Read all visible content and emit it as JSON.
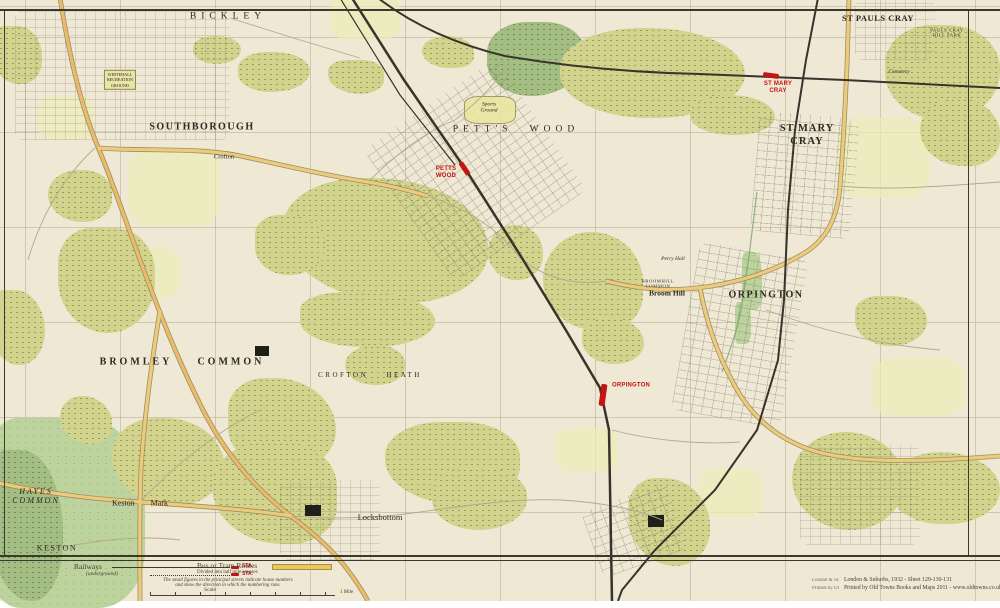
{
  "colors": {
    "paper": "#efe8d4",
    "woodland": "#d2d48e",
    "common_green": "#bdd39e",
    "road_main": "#eccb7d",
    "rail": "#36342c",
    "station_red": "#c41414",
    "grid": "#b9b096"
  },
  "places": [
    {
      "id": "bickley",
      "label": "BICKLEY",
      "x": 228,
      "y": 17,
      "cls": "town-wide"
    },
    {
      "id": "southborough",
      "label": "SOUTHBOROUGH",
      "x": 202,
      "y": 127,
      "cls": "town"
    },
    {
      "id": "petts-wood",
      "label": "PETT'S WOOD",
      "x": 516,
      "y": 130,
      "cls": "town-wide"
    },
    {
      "id": "st-pauls-cray",
      "label": "ST PAULS CRAY",
      "x": 878,
      "y": 19,
      "cls": "town-sm"
    },
    {
      "id": "pauls-cray-hill-park",
      "label": "PAULS CRAY\nHILL PARK",
      "x": 947,
      "y": 33,
      "cls": "tiny-caps"
    },
    {
      "id": "st-mary-cray",
      "label": "ST MARY\nCRAY",
      "x": 807,
      "y": 135,
      "cls": "town-2line"
    },
    {
      "id": "orpington",
      "label": "ORPINGTON",
      "x": 766,
      "y": 295,
      "cls": "town"
    },
    {
      "id": "bromley-common",
      "label": "BROMLEY COMMON",
      "x": 182,
      "y": 362,
      "cls": "town-gap"
    },
    {
      "id": "crofton-heath",
      "label": "CROFTON HEATH",
      "x": 370,
      "y": 375,
      "cls": "small-caps"
    },
    {
      "id": "hayes-common",
      "label": "HAYES\nCOMMON",
      "x": 36,
      "y": 496,
      "cls": "common-label"
    },
    {
      "id": "keston-mark",
      "label": "Keston Mark",
      "x": 140,
      "y": 503,
      "cls": "village-gap"
    },
    {
      "id": "keston",
      "label": "KESTON",
      "x": 57,
      "y": 548,
      "cls": "village-caps"
    },
    {
      "id": "locksbottom",
      "label": "Locksbottom",
      "x": 380,
      "y": 518,
      "cls": "village"
    },
    {
      "id": "broom-hill",
      "label": "Broom Hill",
      "x": 667,
      "y": 294,
      "cls": "hamlet"
    },
    {
      "id": "broomhill-common",
      "label": "BROOMHILL\nCOMMON",
      "x": 658,
      "y": 284,
      "cls": "tiny-caps"
    },
    {
      "id": "perry-hall",
      "label": "Perry Hall",
      "x": 673,
      "y": 259,
      "cls": "tiny-italic"
    },
    {
      "id": "cemetery",
      "label": "Cemetery",
      "x": 899,
      "y": 72,
      "cls": "tiny-italic"
    },
    {
      "id": "crofton",
      "label": "Crofton",
      "x": 224,
      "y": 157,
      "cls": "tiny"
    },
    {
      "id": "whitehall-rec",
      "label": "WHITEHALL\nRECREATION\nGROUND",
      "x": 120,
      "y": 80,
      "cls": "boxed"
    },
    {
      "id": "sports-ground",
      "label": "Sports\nGround",
      "x": 489,
      "y": 108,
      "cls": "tiny-italic"
    }
  ],
  "stations": [
    {
      "id": "petts-wood-station",
      "label": "PETTS\nWOOD",
      "lx": 446,
      "ly": 173,
      "bx": 464,
      "by": 168,
      "bw": 15,
      "bh": 5,
      "rot": 56
    },
    {
      "id": "st-mary-cray-station",
      "label": "ST MARY\nCRAY",
      "lx": 778,
      "ly": 88,
      "bx": 771,
      "by": 75,
      "bw": 16,
      "bh": 5,
      "rot": 8
    },
    {
      "id": "orpington-station",
      "label": "ORPINGTON",
      "lx": 631,
      "ly": 386,
      "bx": 603,
      "by": 395,
      "bw": 6,
      "bh": 22,
      "rot": 8
    }
  ],
  "legend": {
    "railways_label": "Railways",
    "railways_sub": "(underground)",
    "sta_label": "STA.",
    "bus_label": "Bus or Tram Routes",
    "bus_sub": "Divided into half mile squares",
    "note_line1": "The small figures in the principal streets indicate house numbers",
    "note_line2": "and show the direction in which the numbering runs.",
    "scale_label": "Scale",
    "scale_end": "1 Mile"
  },
  "attribution": {
    "ghost1": "London & Sc",
    "line1": "London & Suburbs, 1932 - Sheet 129-130-131",
    "ghost2": "Printed by Ol",
    "line2": "Printed by Old Towns Books and Maps 2011 - www.oldtowns.co.uk"
  }
}
